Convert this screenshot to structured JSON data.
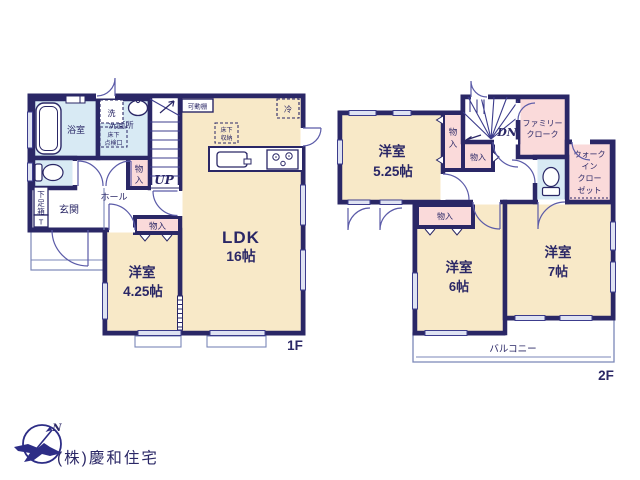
{
  "colors": {
    "wall_navy": "#2a2766",
    "room_cream": "#f8e9c8",
    "closet_pink": "#fadada",
    "sanitary_blue": "#d8eaf4",
    "window_fill": "#dfe3f2",
    "thin_line": "#7b87b8",
    "company_text": "#c9c9c9",
    "logo_navy": "#2d2d86"
  },
  "floor1": {
    "floor_label": "1F",
    "bath_label": "浴室",
    "washroom_label": "洗面所",
    "washer_label": "洗",
    "inspection_lines": [
      "床下",
      "点検口"
    ],
    "shoe_box_lines": [
      "下",
      "足",
      "箱"
    ],
    "shoe_box_t": "T",
    "entrance_label": "玄関",
    "hall_label": "ホール",
    "closet_a_lines": [
      "物",
      "入"
    ],
    "closet_b_label": "物入",
    "stairs_label": "UP",
    "shelf_label": "可動棚",
    "fridge_label": "冷",
    "floor_storage_lines": [
      "床下",
      "収納"
    ],
    "ldk_name": "LDK",
    "ldk_size": "16帖",
    "room425_name": "洋室",
    "room425_size": "4.25帖"
  },
  "floor2": {
    "floor_label": "2F",
    "room525_name": "洋室",
    "room525_size": "5.25帖",
    "closet_a_lines": [
      "物",
      "入"
    ],
    "closet_b_label": "物入",
    "closet_c_label": "物入",
    "stairs_label": "DN",
    "family_closet_lines": [
      "ファミリー",
      "クローク"
    ],
    "wic_lines": [
      "ウォーク",
      "イン",
      "クロー",
      "ゼット"
    ],
    "room6_name": "洋室",
    "room6_size": "6帖",
    "room7_name": "洋室",
    "room7_size": "7帖",
    "balcony_label": "バルコニー"
  },
  "footer": {
    "company": "(株)慶和住宅",
    "compass_n": "N"
  }
}
